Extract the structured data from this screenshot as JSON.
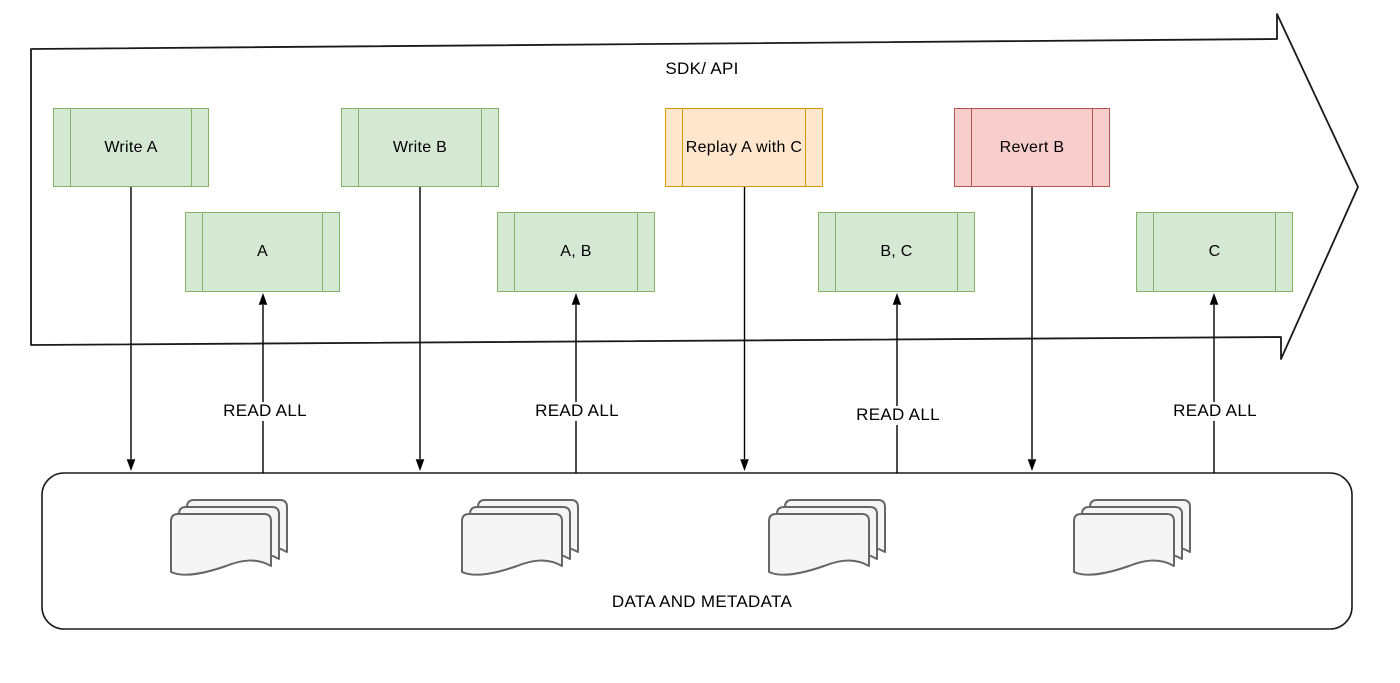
{
  "diagram": {
    "title": "SDK/ API",
    "read_all_label": "READ ALL",
    "colors": {
      "green": {
        "fill": "#d5e8d4",
        "stroke": "#82b366"
      },
      "orange": {
        "fill": "#ffe6cc",
        "stroke": "#d79b00"
      },
      "red": {
        "fill": "#f8cecc",
        "stroke": "#b85450"
      },
      "line": "#000000",
      "document_fill": "#f5f5f5",
      "document_stroke": "#666666"
    },
    "operations": [
      {
        "label": "Write A",
        "color": "green"
      },
      {
        "label": "Write B",
        "color": "green"
      },
      {
        "label": "Replay A with C",
        "color": "orange"
      },
      {
        "label": "Revert B",
        "color": "red"
      }
    ],
    "states": [
      {
        "label": "A",
        "color": "green"
      },
      {
        "label": "A, B",
        "color": "green"
      },
      {
        "label": "B, C",
        "color": "green"
      },
      {
        "label": "C",
        "color": "green"
      }
    ],
    "storage": {
      "label": "DATA AND METADATA",
      "icon": "document-stack-icon",
      "stack_count": 4
    }
  }
}
